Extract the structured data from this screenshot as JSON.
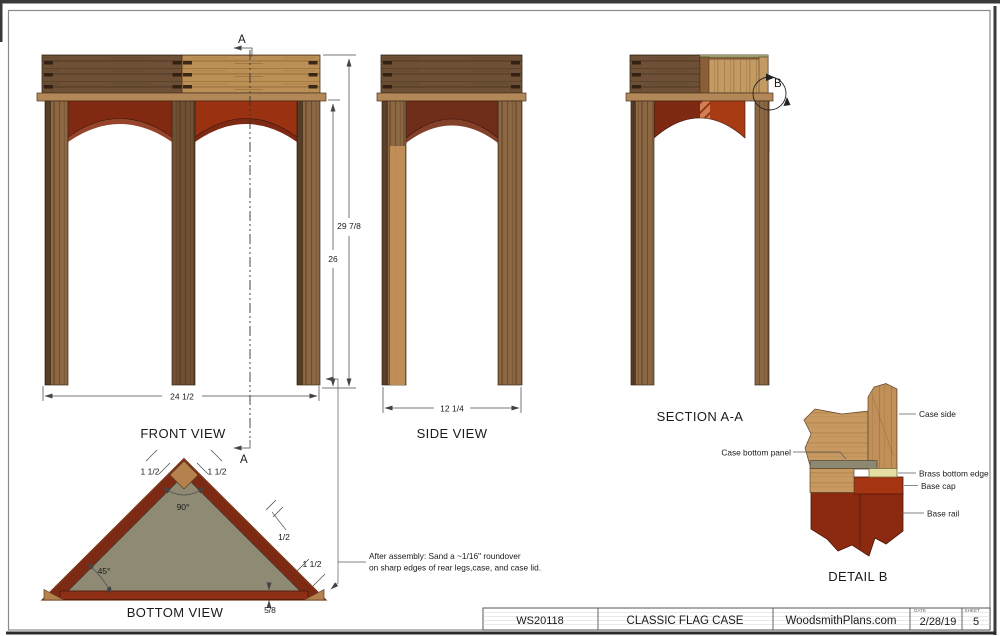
{
  "views": {
    "front": {
      "label": "FRONT VIEW",
      "dims": {
        "width": "24 1/2",
        "height_table": "26",
        "height_total": "29 7/8"
      }
    },
    "side": {
      "label": "SIDE VIEW",
      "dims": {
        "width": "12 1/4"
      }
    },
    "section": {
      "label": "SECTION A-A"
    },
    "bottom": {
      "label": "BOTTOM VIEW",
      "dims": {
        "apex_left": "1 1/2",
        "apex_right": "1 1/2",
        "apex_angle": "90°",
        "base_angle": "45°",
        "side_half": "1/2",
        "corner": "1 1/2",
        "base_strip": "5/8"
      }
    },
    "detail_b": {
      "label": "DETAIL B",
      "callouts": {
        "case_side": "Case side",
        "case_bottom_panel": "Case bottom panel",
        "brass_bottom_edge": "Brass bottom edge",
        "base_cap": "Base cap",
        "base_rail": "Base rail"
      }
    }
  },
  "markers": {
    "section": "A",
    "detail": "B"
  },
  "note": {
    "line1": "After assembly: Sand a ~1/16\" roundover",
    "line2": "on sharp edges of rear legs,case, and case lid."
  },
  "title_block": {
    "plan_number": "WS20118",
    "title": "CLASSIC FLAG CASE",
    "website": "WoodsmithPlans.com",
    "date_label": "DATE",
    "date": "2/28/19",
    "sheet_label": "SHEET",
    "sheet": "5"
  },
  "colors": {
    "wood_light": "#bb9057",
    "wood_dark": "#6d5035",
    "leg_wood": "#8c6743",
    "tabletop": "#b28858",
    "apron_red": "#9a3111",
    "apron_dark_red": "#6f2d1a",
    "section_red": "#a83b14",
    "hatch_red": "#cf7f52",
    "panel_olive": "#8f8a74",
    "brass": "#e6dfa3",
    "base_cap_red": "#a43412",
    "base_rail_red": "#8b2a11"
  }
}
